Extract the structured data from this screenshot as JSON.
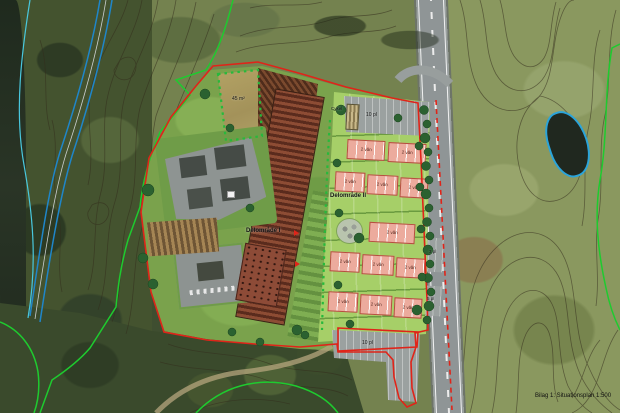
{
  "document": {
    "caption": "Bilag 1: Situationsplan 1:500"
  },
  "plan": {
    "areas": [
      {
        "id": "delomrade-1",
        "label": "Delområde I"
      },
      {
        "id": "delomrade-2",
        "label": "Delområde II"
      }
    ],
    "labels": {
      "storeys": "2 vån",
      "parking_top": "10 pl",
      "parking_bottom": "10 pl",
      "parking_east_a": "3 pl",
      "parking_east_b": "5 pl",
      "field_area": "45 m²",
      "bike_shed": "Cykel"
    },
    "features": {
      "boundary_plan": "red plan boundary",
      "boundary_nature": "green boundary line",
      "watercourse": "blue stream lines",
      "contours": "terrain contour lines",
      "road": "main road with dashed centerline",
      "pond": "pond outlined in blue",
      "housing_rows": 5,
      "house_blocks": 12
    },
    "colors": {
      "boundary_red": "#e02419",
      "boundary_green": "#1ecb2f",
      "water_blue": "#1f86c9",
      "water_cyan": "#49c8de",
      "contour": "#332c1c",
      "house_fill": "#ecab9d",
      "house_edge": "#b4503f",
      "plot_green": "#a6cf68",
      "lawn_green": "#7aa24c",
      "parking_grey": "#9ba1a0",
      "road_grey": "#8f9596",
      "field_tan": "#b3a264",
      "roof_brown": "#6e3a26"
    }
  }
}
